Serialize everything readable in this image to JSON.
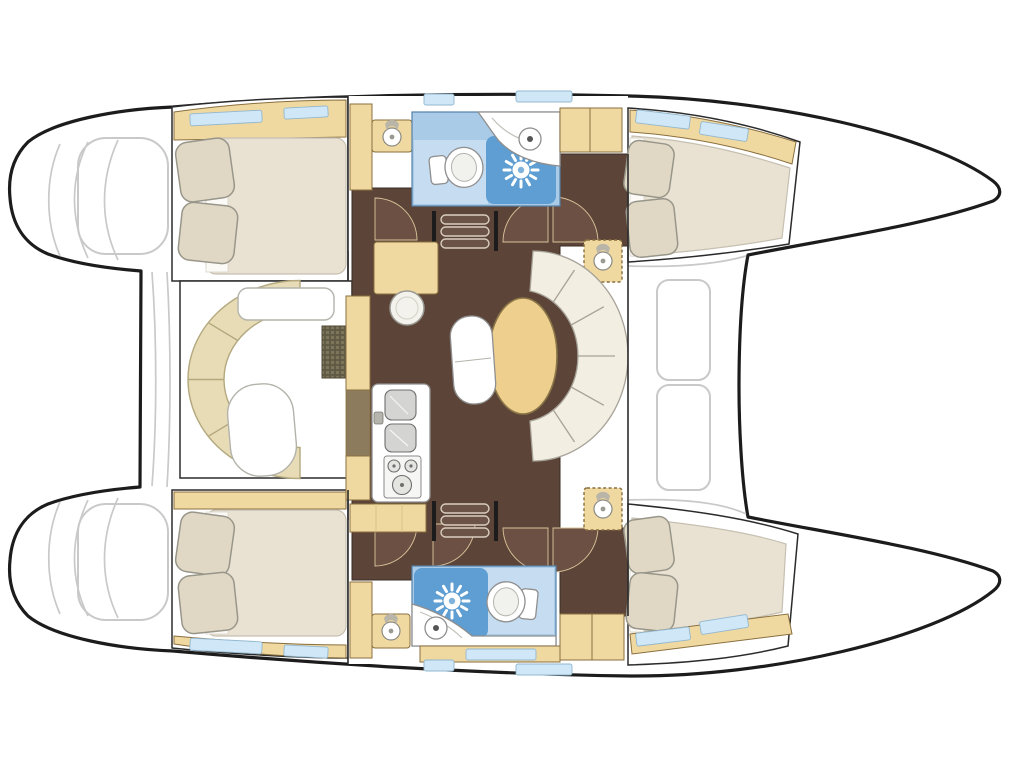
{
  "page": {
    "title": "Catamaran interior layout floor plan",
    "background": "#ffffff"
  },
  "palette": {
    "hull_outline": "#1c1c1c",
    "deck_line": "#c9c9c9",
    "wall": "#2b2b2b",
    "floor_dark": "#5c4538",
    "door_maroon": "#6d5044",
    "door_edge": "#d8c49a",
    "cabinet_tan": "#f0d9a1",
    "cabinet_edge": "#8a6f3e",
    "cabinet_brown": "#8d7b5e",
    "sofa_tan": "#e8dcb6",
    "sofa_edge": "#b3a87e",
    "bench_cream": "#f2eee1",
    "bench_edge": "#a8a399",
    "dinette_table": "#eecf8e",
    "table_edge": "#8a7547",
    "bed": "#e9e2d3",
    "bed_edge": "#c6c0b2",
    "pillow": "#e0d8c4",
    "pillow_edge": "#98968a",
    "sheet": "#fbfaf6",
    "bath_blue": "#a9cbe7",
    "bath_blue_pale": "#c6dcf0",
    "bath_blue_deep": "#5e9ed2",
    "bath_edge": "#5580a8",
    "window_blue": "#cfe7f6",
    "window_edge": "#93b7cf",
    "fixture_white": "#ffffff",
    "fixture_edge": "#8f8f8f",
    "grate_dark": "#5f5944",
    "grate_light": "#7d755a",
    "steps_fill": "#6b5347",
    "steps_edge": "#d9cec0",
    "stool": "#f4f2ec"
  },
  "plan": {
    "type": "floor-plan",
    "vessel": "Sailing catamaran interior layout, bow to the right, two hulls with central bridgedeck saloon",
    "port_hull": {
      "stern_platform": {
        "step_lines": 3
      },
      "aft_cabin": {
        "double_berth": 1,
        "pillows": 2,
        "hull_windows": 2,
        "shelf_strip": 1
      },
      "head": {
        "toilet": 1,
        "shower_rose": 1,
        "round_washbasin": 1,
        "vanity_washbasin": 1,
        "wardrobe": 1
      },
      "forward_cabin": {
        "double_berth": 1,
        "pillows": 2,
        "hull_windows": 2,
        "vanity_washbasin": 1,
        "wardrobe": 1
      }
    },
    "starboard_hull": {
      "stern_platform": {
        "step_lines": 3
      },
      "aft_cabin": {
        "double_berth": 1,
        "pillows": 2,
        "hull_windows": 2,
        "shelf_strip": 1
      },
      "head": {
        "toilet": 1,
        "shower_rose": 1,
        "round_washbasin": 1,
        "vanity_washbasin": 1,
        "wardrobe": 1
      },
      "forward_cabin": {
        "double_berth": 1,
        "pillows": 2,
        "hull_windows": 2,
        "vanity_washbasin": 1,
        "wardrobe": 1
      }
    },
    "bridgedeck": {
      "saloon": {
        "curved_sofa_segments": 6,
        "coffee_table": 1,
        "side_console": 1,
        "floor_hatch_grate": 1
      },
      "galley": {
        "double_sink": 1,
        "stove_burners": 3,
        "worktops": 4
      },
      "chart_area": {
        "chart_table": 1,
        "stool": 1
      },
      "dinette": {
        "oval_table": 1,
        "curved_bench_segments": 6,
        "companion_seat": 1
      },
      "companionway_steps": 2,
      "interior_door_arcs": 7,
      "deck_windows": 2
    },
    "foredeck": {
      "coachroof_hatches": 2
    }
  }
}
